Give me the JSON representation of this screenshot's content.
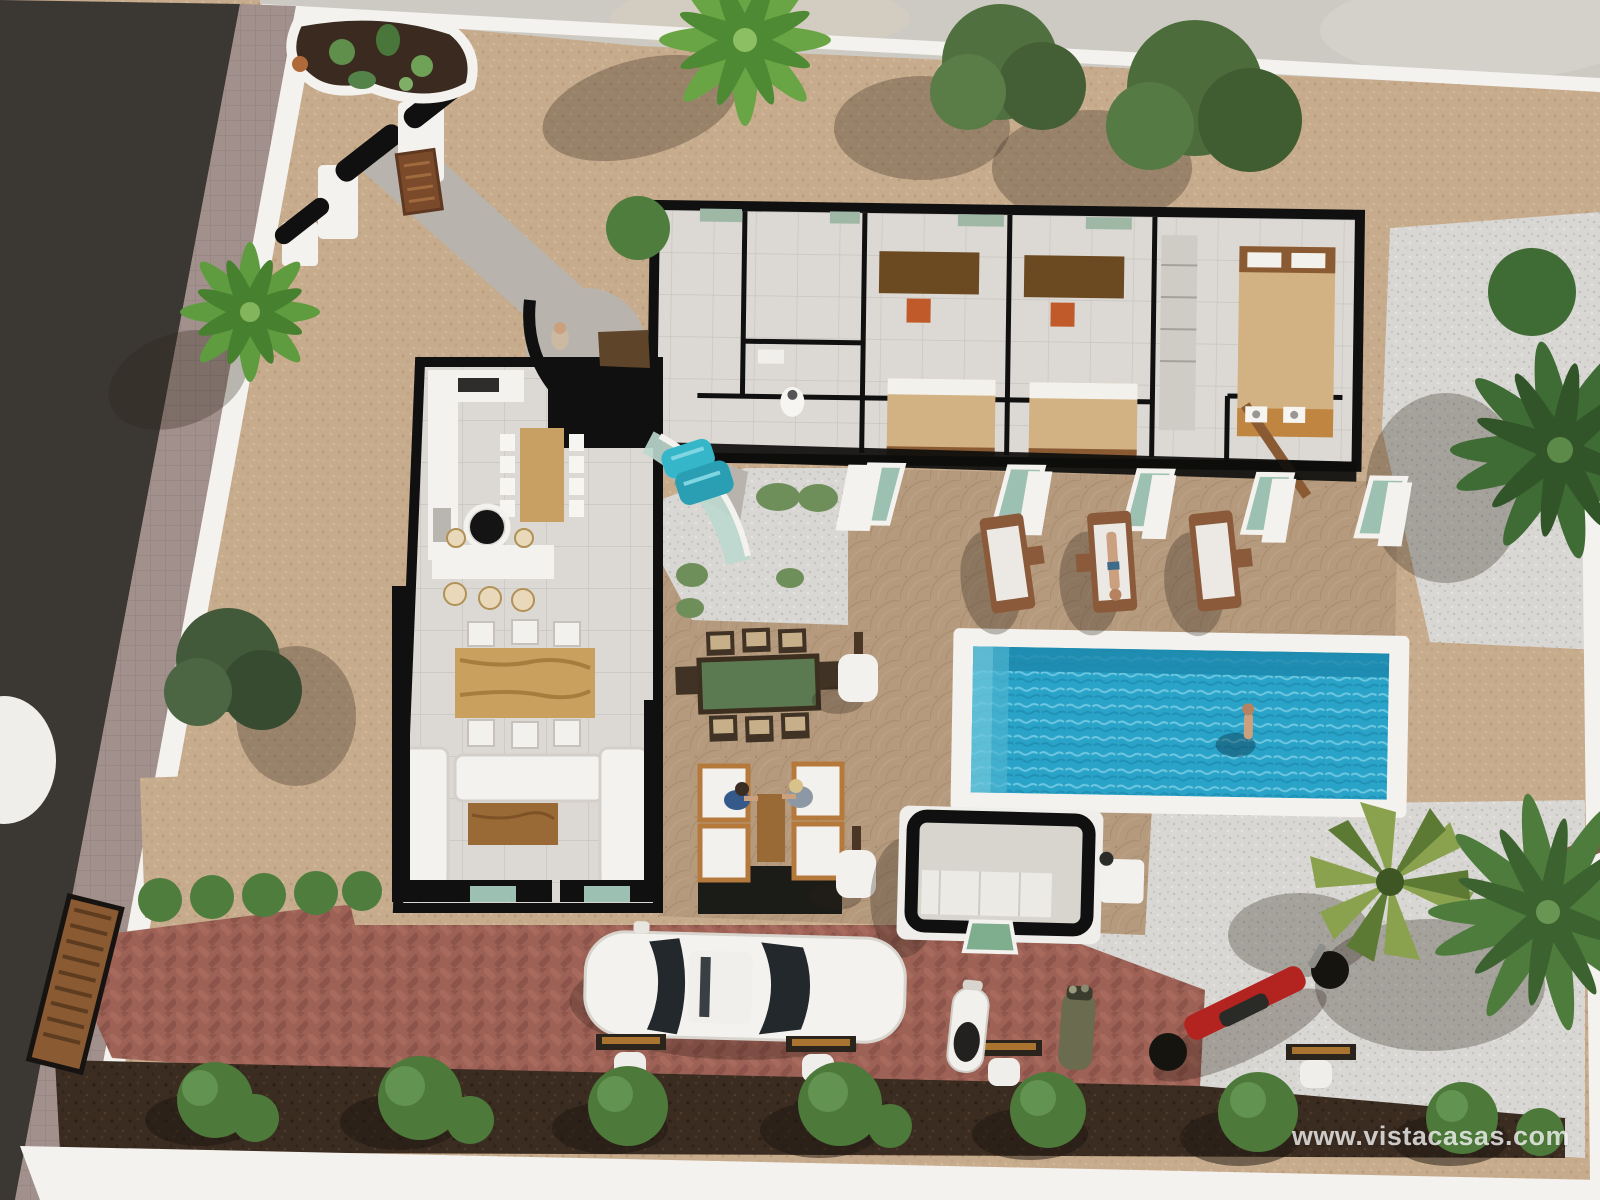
{
  "watermark": {
    "text": "www.vistacasas.com"
  },
  "scene": {
    "type": "3d-aerial-architectural-render",
    "subject": "single-storey villa plot, top-down cutaway view",
    "objects": [
      "asphalt-road",
      "sidewalk",
      "boundary-wall",
      "entrance-gate",
      "gate-sign",
      "cactus-planter",
      "concrete-walkway",
      "bedroom-wing",
      "three-bedrooms",
      "master-bedroom",
      "bathrooms",
      "open-living-wing",
      "kitchen",
      "breakfast-bar",
      "dining-table",
      "sofa-set",
      "entrance-courtyard",
      "person-standing",
      "glass-canopy",
      "turquoise-chairs",
      "swimming-pool",
      "swimmer",
      "sun-loungers",
      "sunbather",
      "outdoor-dining-set",
      "lounge-armchairs",
      "two-people-seated",
      "lamp-planters",
      "pool-house",
      "white-car",
      "scooter",
      "golf-bag",
      "red-motorcycle",
      "parking-benches",
      "brick-driveway",
      "cobblestone-patio",
      "white-gravel",
      "tan-gravel",
      "palm-trees",
      "green-trees",
      "shrub-row",
      "wooden-side-gate"
    ],
    "people_count": 5
  },
  "palette": {
    "road": "#3b3733",
    "sidewalk": "#a2908c",
    "wall_white": "#f4f2ee",
    "gravel_tan": "#c7ab8d",
    "gravel_white": "#d8d7d3",
    "cobble": "#b59a7d",
    "brick": "#9d6156",
    "soil": "#3a2c21",
    "pool_water": "#2aa3c8",
    "roof_outline": "#101010",
    "wood": "#c9a063",
    "accent_turquoise": "#35b6c9",
    "foliage": "#4d7c3c",
    "bed_tan": "#d2b183",
    "chair_orange": "#c05a2a"
  }
}
